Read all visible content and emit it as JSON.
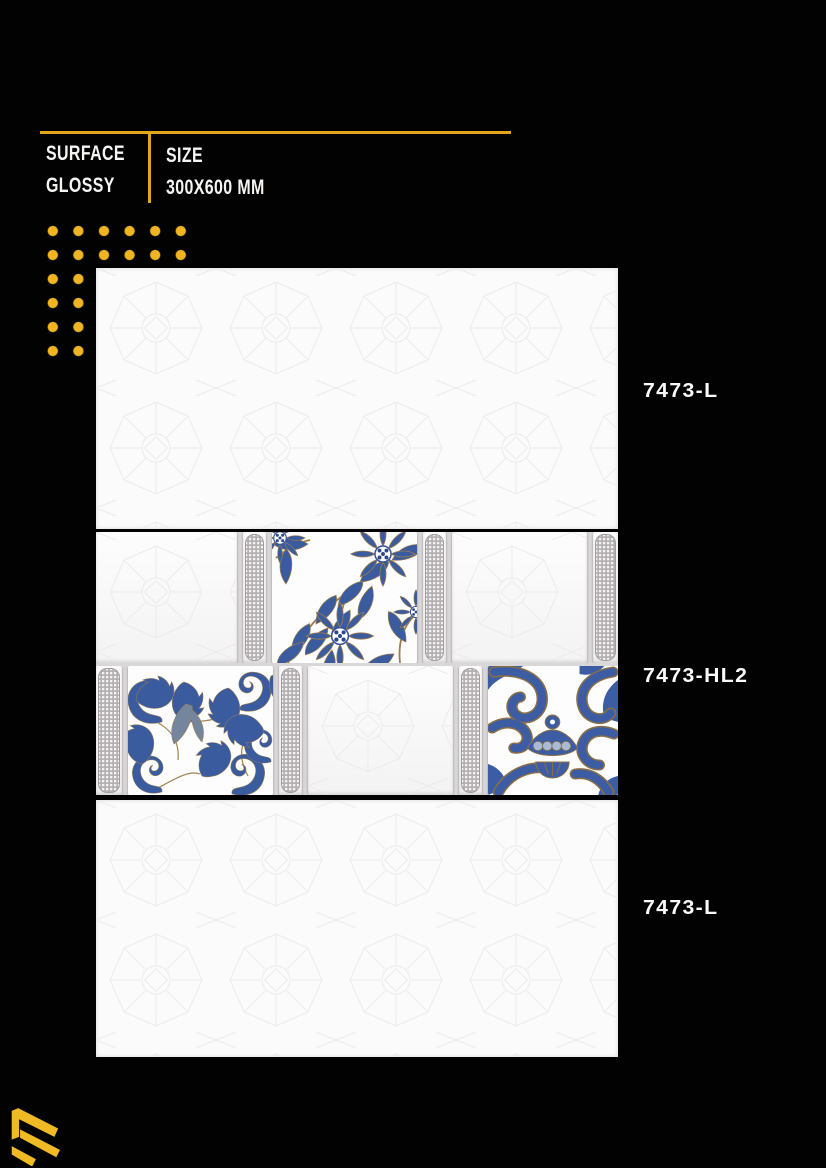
{
  "page": {
    "background_color": "#020202",
    "accent_gold": "#E3A51C",
    "dot_gold": "#EEB421"
  },
  "spec_header": {
    "surface_label": "SURFACE",
    "surface_value": "GLOSSY",
    "size_label": "SIZE",
    "size_value": "300X600 MM"
  },
  "tiles": [
    {
      "code": "7473-L",
      "style": "plain-light-tile"
    },
    {
      "code": "7473-HL2",
      "style": "highlighter-decor-tile"
    },
    {
      "code": "7473-L",
      "style": "plain-light-tile"
    }
  ],
  "decor_motifs": {
    "top_center": "blue-floral-bouquet",
    "bottom_left": "blue-acanthus-scroll",
    "bottom_right": "blue-damask-swirl",
    "strips": "grey-mosaic-strip"
  },
  "palette": {
    "decor_blue": "#3B5B9F",
    "decor_blue_dark": "#2C488B",
    "decor_gold": "#A1824E",
    "strip_gray": "#B5B1B3",
    "tile_white": "#FBFBFB"
  },
  "logo": {
    "icon": "layered-chevron-logo",
    "color": "#F0BA24"
  }
}
